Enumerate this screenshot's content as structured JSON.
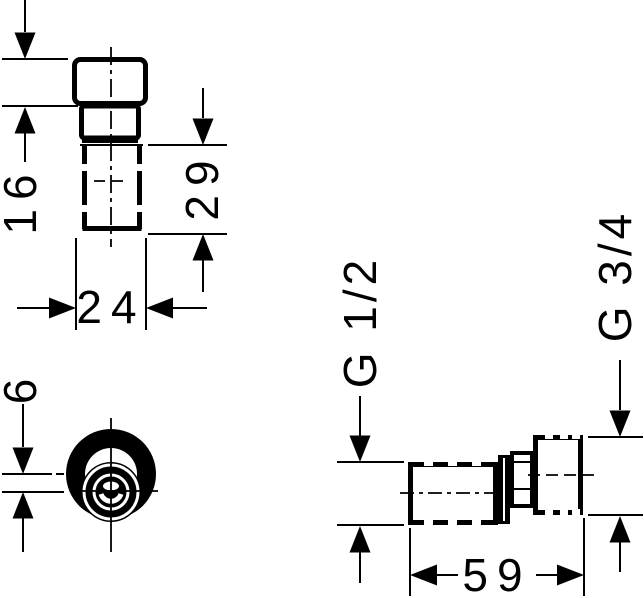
{
  "drawing": {
    "type": "technical-dimension-drawing",
    "part": "eccentric pipe union fitting",
    "dimensions": {
      "front_height": "16",
      "thread_length": "29",
      "front_width": "24",
      "eccentric_offset": "6",
      "overall_length": "59",
      "thread_left": "G 1/2",
      "thread_right": "G 3/4"
    },
    "colors": {
      "line": "#000000",
      "background": "#ffffff"
    }
  }
}
